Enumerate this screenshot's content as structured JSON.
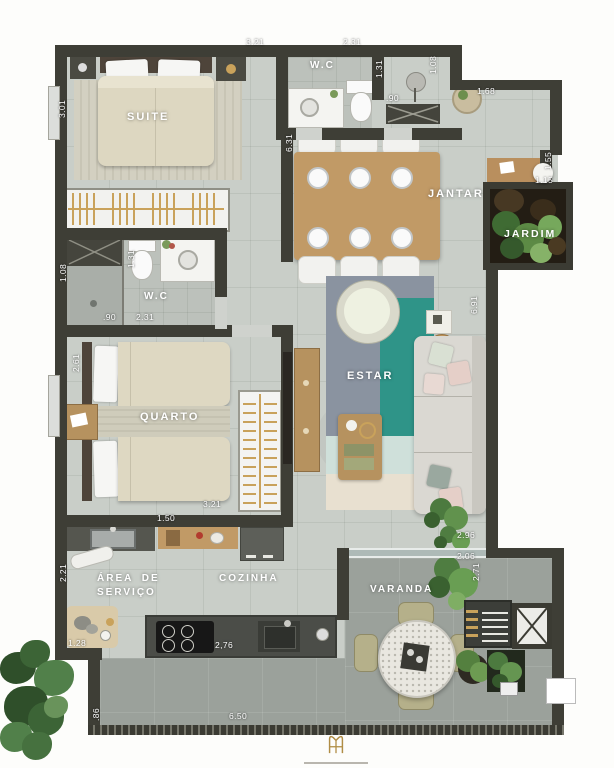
{
  "rooms": {
    "suite": "SUITE",
    "wc_suite": "W.C",
    "jantar": "JANTAR",
    "jardim": "JARDIM",
    "wc_social": "W.C",
    "quarto": "QUARTO",
    "estar": "ESTAR",
    "area_servico_line1": "ÁREA DE",
    "area_servico_line2": "SERVIÇO",
    "cozinha": "COZINHA",
    "varanda": "VARANDA"
  },
  "dimensions_m": {
    "suite_width": "3.21",
    "suite_depth": "3.01",
    "wc_suite_width": "2.31",
    "wc_suite_depth": "1.31",
    "wc_suite_door": ".90",
    "entry_depth": "1.08",
    "entry_width": "1.68",
    "desk_nook_depth": "1.55",
    "desk_nook_width": "1.15",
    "jantar_length": "6.31",
    "estar_length": "6.91",
    "wc_social_depth": "1.08",
    "wc_social_inner": "1.31",
    "wc_social_door": ".90",
    "wc_social_width": "2.31",
    "quarto_depth": "2.61",
    "quarto_width": "3.21",
    "servico_depth": "2.21",
    "cozinha_counter": "1.50",
    "pet_area": "1.28",
    "island_width": "2,76",
    "varanda_width_a": "2.96",
    "varanda_width_b": "2.06",
    "varanda_depth": "2.71",
    "terrace_side": ".86",
    "terrace_width": "6.50"
  },
  "colors": {
    "wall": "#3e3e36",
    "floor": "#c9cec8",
    "terrace_floor": "#9ba19b",
    "rug_teal": "#2f9488",
    "rug_slate": "#8a93a0",
    "wood": "#c19a66",
    "gold": "#c9a25b",
    "garden_soil": "#231d14"
  },
  "logo": {
    "icon": "gold-monogram-icon"
  }
}
